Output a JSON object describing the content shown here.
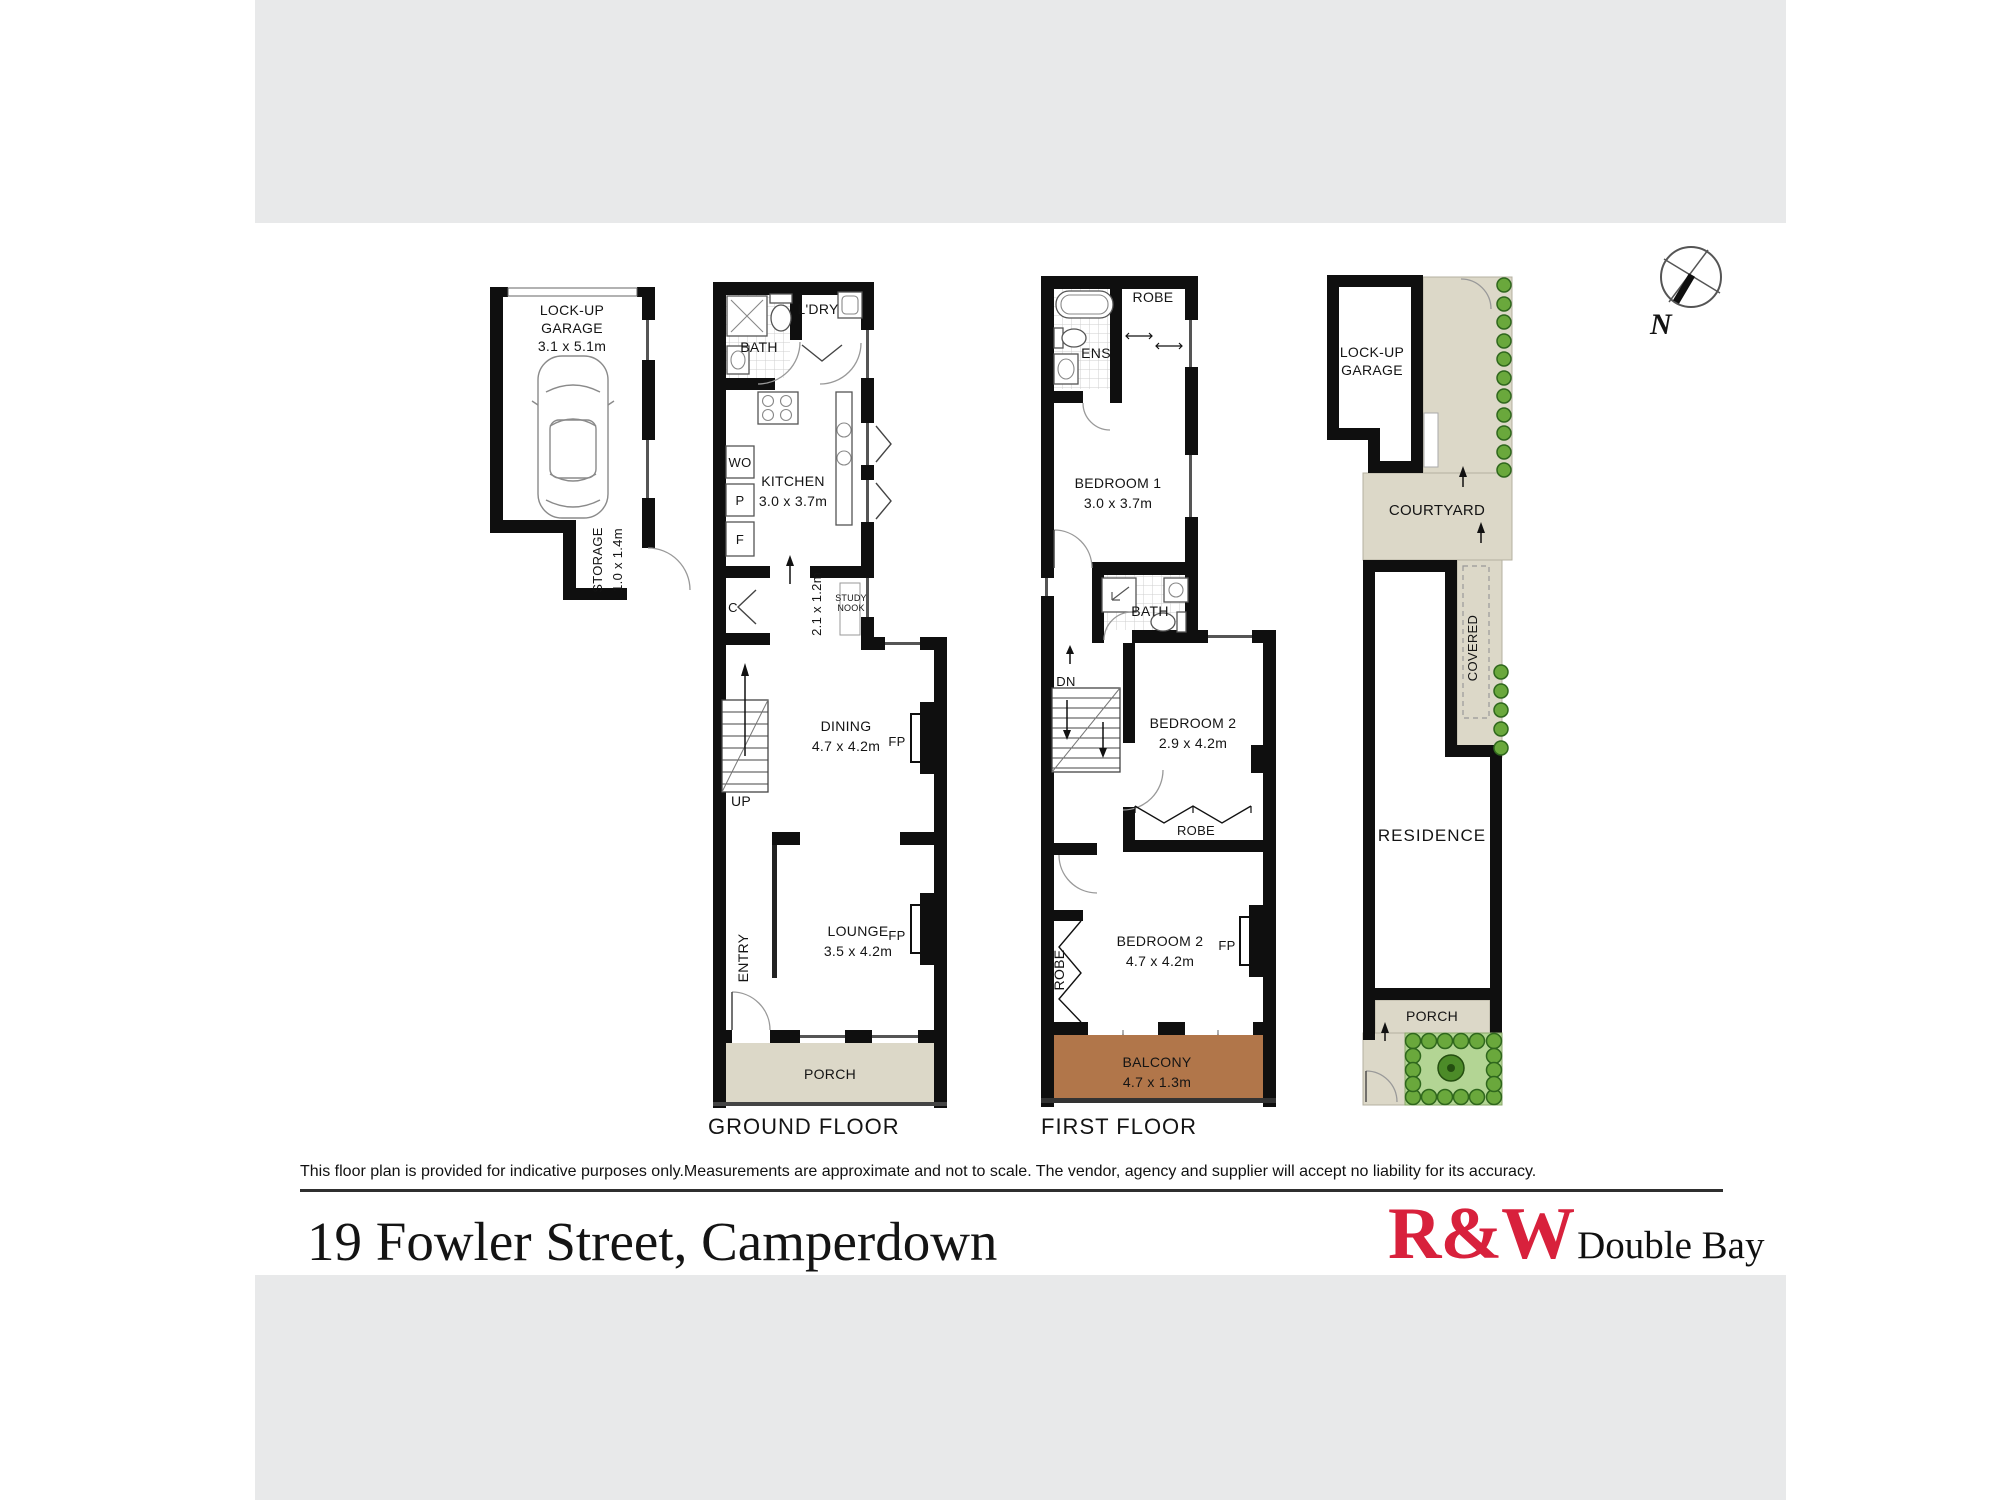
{
  "page": {
    "address": "19 Fowler Street, Camperdown",
    "disclaimer": "This floor plan is provided for indicative purposes only.Measurements are approximate and not to scale. The vendor, agency and supplier will accept no liability for its accuracy.",
    "brand": {
      "name": "R&W",
      "office": "Double Bay"
    },
    "compass": {
      "label": "N"
    },
    "colors": {
      "brand_red": "#d8213c",
      "balcony_brown": "#b1764a",
      "paving_beige": "#dcd8c8",
      "garden_green": "#b3d594",
      "band_gray": "#e8e9ea"
    }
  },
  "ground_floor": {
    "title": "GROUND FLOOR",
    "garage": {
      "line1": "LOCK-UP",
      "line2": "GARAGE",
      "dim": "3.1 x 5.1m"
    },
    "storage": {
      "name": "STORAGE",
      "dim": "1.0 x 1.4m"
    },
    "bath": "BATH",
    "laundry": "L'DRY",
    "kitchen": {
      "name": "KITCHEN",
      "dim": "3.0 x 3.7m"
    },
    "appliances": {
      "wall_oven": "WO",
      "pantry": "P",
      "fridge": "F",
      "cupboard": "C"
    },
    "nook": {
      "dim": "2.1 x 1.2m",
      "line1": "STUDY",
      "line2": "NOOK"
    },
    "dining": {
      "name": "DINING",
      "dim": "4.7 x 4.2m",
      "fp": "FP"
    },
    "stairs": "UP",
    "lounge": {
      "name": "LOUNGE",
      "dim": "3.5 x 4.2m",
      "fp": "FP"
    },
    "entry": "ENTRY",
    "porch": "PORCH"
  },
  "first_floor": {
    "title": "FIRST FLOOR",
    "ensuite": "ENS",
    "robe_top": "ROBE",
    "bedroom1": {
      "name": "BEDROOM 1",
      "dim": "3.0 x 3.7m"
    },
    "bath": "BATH",
    "stairs": "DN",
    "bedroom2": {
      "name": "BEDROOM 2",
      "dim": "2.9 x 4.2m"
    },
    "robe_mid": "ROBE",
    "bedroom3": {
      "name": "BEDROOM 2",
      "dim": "4.7 x 4.2m",
      "fp": "FP"
    },
    "robe_left": "ROBE",
    "balcony": {
      "name": "BALCONY",
      "dim": "4.7 x 1.3m"
    }
  },
  "site_plan": {
    "garage": {
      "line1": "LOCK-UP",
      "line2": "GARAGE"
    },
    "courtyard": "COURTYARD",
    "covered": "COVERED",
    "residence": "RESIDENCE",
    "porch": "PORCH"
  }
}
